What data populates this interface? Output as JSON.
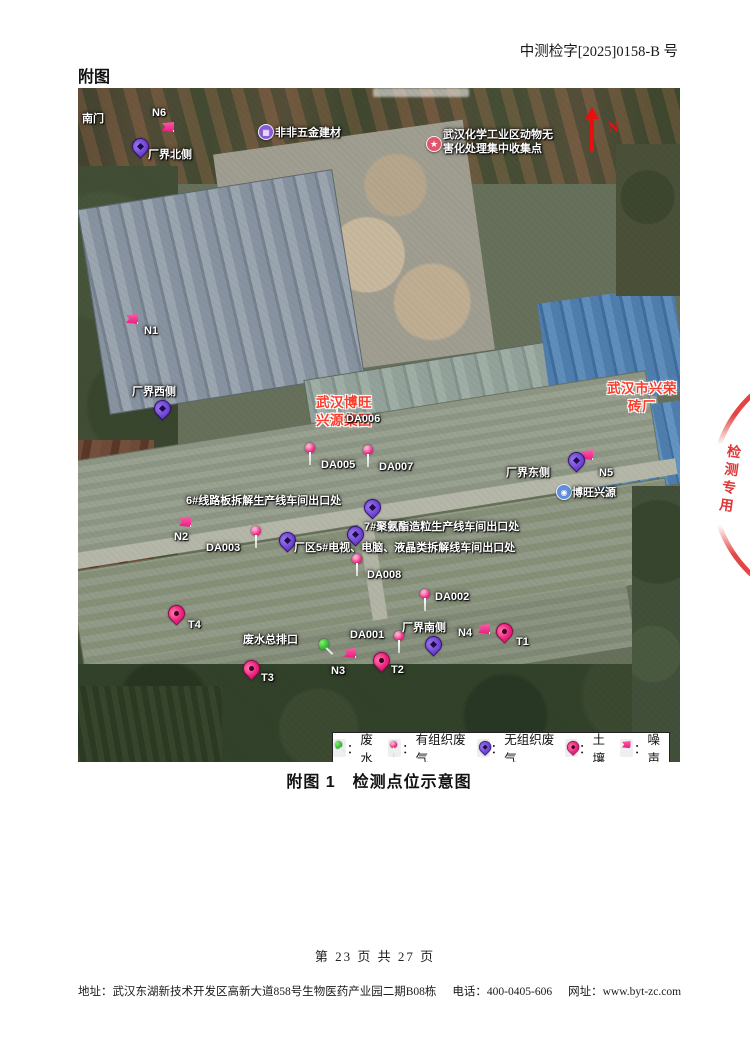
{
  "page": {
    "doc_number": "中测检字[2025]0158-B 号",
    "section_heading": "附图",
    "figure_caption": "附图 1　检测点位示意图",
    "page_number": "第 23 页 共 27 页",
    "footer": {
      "address": "地址：武汉东湖新技术开发区高新大道858号生物医药产业园二期B08栋",
      "phone": "电话：400-0405-606",
      "website": "网址：www.byt-zc.com"
    },
    "stamp_text": "检测专用"
  },
  "colors": {
    "organized_gas": "#ef2a88",
    "unorganized_gas": "#6a3fd0",
    "soil": "#e91c79",
    "noise": "#f43f9e",
    "wastewater": "#2eb832",
    "north_arrow": "#e80f0f",
    "red_place_label": "#fb3b2a",
    "stamp_red": "#de2828"
  },
  "map": {
    "north_label": "N",
    "legend": {
      "separator": "：",
      "items": [
        {
          "icon": "pushpin",
          "label": "废水"
        },
        {
          "icon": "balloon",
          "label": "有组织废气"
        },
        {
          "icon": "ppin",
          "label": "无组织废气"
        },
        {
          "icon": "spin",
          "label": "土壤"
        },
        {
          "icon": "flag",
          "label": "噪声"
        }
      ]
    },
    "markers": [
      {
        "t": "text",
        "label": "南门",
        "lx": 4,
        "ly": 24
      },
      {
        "t": "flag",
        "x": 84,
        "y": 34,
        "label": "N6",
        "lx": 74,
        "ly": 18
      },
      {
        "t": "ppin",
        "x": 54,
        "y": 50,
        "label": "厂界北侧",
        "lx": 70,
        "ly": 60
      },
      {
        "t": "poi",
        "x": 180,
        "y": 36,
        "glyph": "▦",
        "color": "#8a5bd6",
        "label": "非非五金建材",
        "lx": 197,
        "ly": 38
      },
      {
        "t": "star",
        "x": 348,
        "y": 48,
        "glyph": "★",
        "color": "#e2556b",
        "label": [
          "武汉化学工业区动物无",
          "害化处理集中收集点"
        ],
        "lx": 365,
        "ly": 40
      },
      {
        "t": "flag",
        "x": 48,
        "y": 226,
        "label": "N1",
        "lx": 66,
        "ly": 236
      },
      {
        "t": "ppin",
        "x": 76,
        "y": 312,
        "label": "厂界西侧",
        "lx": 54,
        "ly": 297
      },
      {
        "t": "red",
        "label": [
          "武汉博旺",
          "兴源集团"
        ],
        "lx": 238,
        "ly": 306
      },
      {
        "t": "balloon",
        "x": 254,
        "y": 308,
        "label": "DA006",
        "lx": 268,
        "ly": 324
      },
      {
        "t": "balloon",
        "x": 227,
        "y": 355,
        "label": "DA005",
        "lx": 243,
        "ly": 370
      },
      {
        "t": "balloon",
        "x": 285,
        "y": 357,
        "label": "DA007",
        "lx": 301,
        "ly": 372
      },
      {
        "t": "red",
        "center": true,
        "label": [
          "武汉市兴荣",
          "砖厂"
        ],
        "lx": 516,
        "ly": 292
      },
      {
        "t": "flag",
        "x": 503,
        "y": 362
      },
      {
        "t": "ppin",
        "x": 490,
        "y": 364,
        "label": "厂界东侧",
        "lx": 428,
        "ly": 378
      },
      {
        "t": "text",
        "label": "N5",
        "lx": 521,
        "ly": 378
      },
      {
        "t": "poi",
        "x": 478,
        "y": 396,
        "glyph": "◉",
        "color": "#5f8fd8",
        "label": "博旺兴源",
        "lx": 494,
        "ly": 398
      },
      {
        "t": "ppin",
        "x": 286,
        "y": 411,
        "label": "6#线路板拆解生产线车间出口处",
        "lx": 108,
        "ly": 406
      },
      {
        "t": "flag",
        "x": 101,
        "y": 429,
        "label": "N2",
        "lx": 96,
        "ly": 442
      },
      {
        "t": "balloon",
        "x": 173,
        "y": 438,
        "label": "DA003",
        "lx": 128,
        "ly": 453
      },
      {
        "t": "ppin",
        "x": 201,
        "y": 444,
        "label": "厂区5#电视、电脑、液晶类拆解线车间出口处",
        "lx": 216,
        "ly": 453
      },
      {
        "t": "ppin",
        "x": 269,
        "y": 438,
        "label": "7#聚氨酯造粒生产线车间出口处",
        "lx": 286,
        "ly": 432
      },
      {
        "t": "balloon",
        "x": 274,
        "y": 466,
        "label": "DA008",
        "lx": 289,
        "ly": 480
      },
      {
        "t": "balloon",
        "x": 342,
        "y": 501,
        "label": "DA002",
        "lx": 357,
        "ly": 502
      },
      {
        "t": "spin",
        "x": 90,
        "y": 517,
        "label": "T4",
        "lx": 110,
        "ly": 530
      },
      {
        "t": "pushpin",
        "x": 241,
        "y": 551,
        "label": "废水总排口",
        "lx": 165,
        "ly": 545
      },
      {
        "t": "balloon",
        "x": 316,
        "y": 543,
        "label": "DA001",
        "lx": 272,
        "ly": 540
      },
      {
        "t": "ppin",
        "x": 347,
        "y": 548,
        "label": "厂界南侧",
        "lx": 324,
        "ly": 533
      },
      {
        "t": "flag",
        "x": 400,
        "y": 536,
        "label": "N4",
        "lx": 380,
        "ly": 538
      },
      {
        "t": "spin",
        "x": 418,
        "y": 535,
        "label": "T1",
        "lx": 438,
        "ly": 547
      },
      {
        "t": "flag",
        "x": 266,
        "y": 560,
        "label": "N3",
        "lx": 253,
        "ly": 576
      },
      {
        "t": "spin",
        "x": 295,
        "y": 564,
        "label": "T2",
        "lx": 313,
        "ly": 575
      },
      {
        "t": "spin",
        "x": 165,
        "y": 572,
        "label": "T3",
        "lx": 183,
        "ly": 583
      }
    ]
  }
}
